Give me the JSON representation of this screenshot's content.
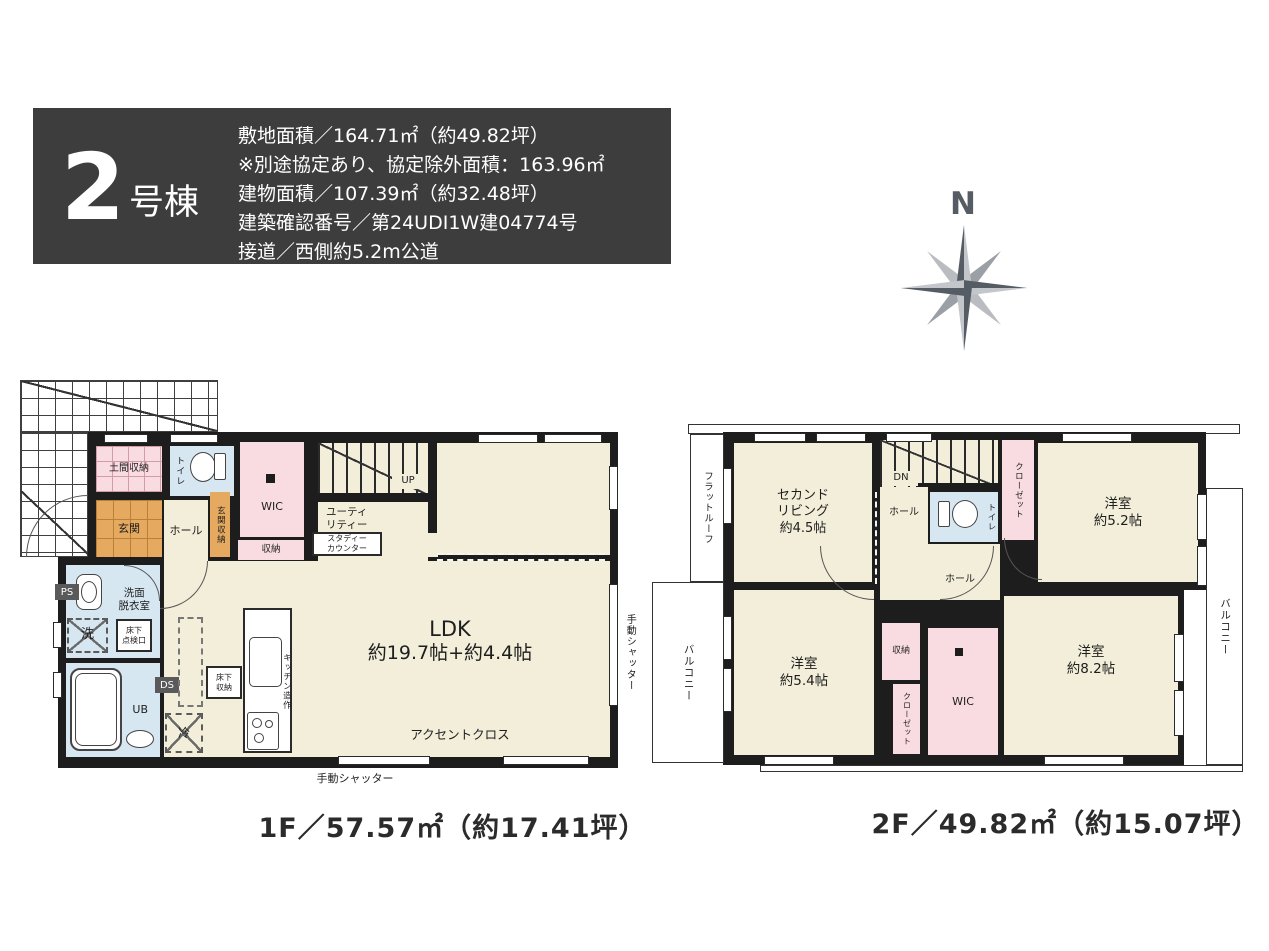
{
  "header": {
    "unit_number": "2",
    "unit_suffix": "号棟",
    "line1": "敷地面積／164.71㎡（約49.82坪）",
    "line2": "※別途協定あり、協定除外面積：163.96㎡",
    "line3": "建物面積／107.39㎡（約32.48坪）",
    "line4": "建築確認番号／第24UDI1W建04774号",
    "line5": "接道／西側約5.2m公道"
  },
  "compass": {
    "north_label": "N"
  },
  "floor1": {
    "caption": "1F／57.57㎡（約17.41坪）",
    "labels": {
      "doma_shuno": "土間収納",
      "toilet": "トイレ",
      "wic": "WIC",
      "up": "UP",
      "genkan": "玄関",
      "hall": "ホール",
      "genkan_shuno": "玄関収納",
      "shuno": "収納",
      "utility": "ユーティ\nリティー",
      "study_counter": "スタディー\nカウンター",
      "ldk": "LDK",
      "ldk_size": "約19.7帖+約4.4帖",
      "senmen": "洗面\n脱衣室",
      "washer": "洗",
      "yukashita_tenkenko": "床下\n点検口",
      "ps": "PS",
      "ds": "DS",
      "ub": "UB",
      "yukashita_shuno": "床下\n収納",
      "fridge": "冷",
      "kitchen": "キッチン造作",
      "accent_cross": "アクセントクロス",
      "shutter_bottom": "手動シャッター",
      "shutter_right": "手動シャッター"
    }
  },
  "floor2": {
    "caption": "2F／49.82㎡（約15.07坪）",
    "labels": {
      "flat_roof": "フラットルーフ",
      "second_living": "セカンド\nリビング\n約4.5帖",
      "dn": "DN",
      "hall_upper": "ホール",
      "toilet": "トイレ",
      "closet_upper": "クローゼット",
      "room52": "洋室\n約5.2帖",
      "hall_lower": "ホール",
      "balcony_left": "バルコニー",
      "room54": "洋室\n約5.4帖",
      "shuno": "収納",
      "closet_lower": "クローゼット",
      "wic": "WIC",
      "room82": "洋室\n約8.2帖",
      "balcony_right": "バルコニー"
    }
  },
  "colors": {
    "wall": "#1d1d1d",
    "room_cream": "#f2eed9",
    "room_pink": "#f9dce2",
    "room_blue": "#d7e7f2",
    "room_orange": "#e5aa5f",
    "header_bg": "#3d3d3d",
    "compass_dark": "#565c63",
    "compass_light": "#c3c6ca"
  }
}
